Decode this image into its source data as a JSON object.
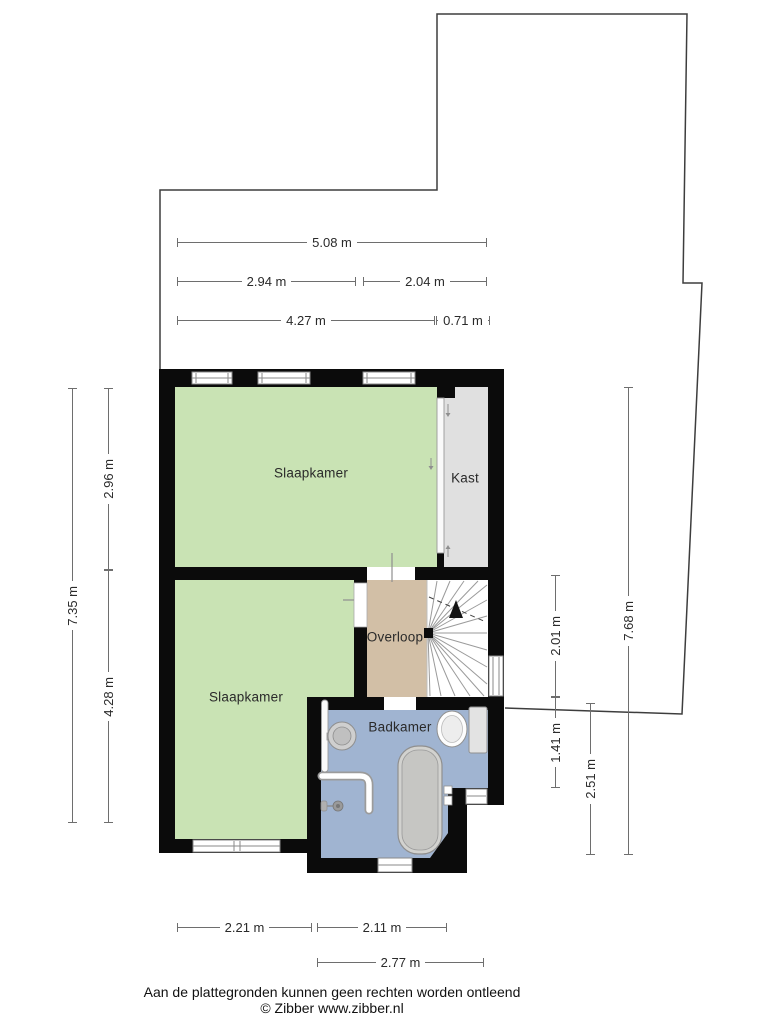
{
  "palette": {
    "wall": "#0b0b0b",
    "boundary": "#3d3d3d",
    "dim-line": "#6e6e6e",
    "text-dark": "#2a2a2a",
    "bedroom-green": "#c9e3b4",
    "closet-gray": "#e0e0e0",
    "landing-tan": "#d2bfa6",
    "bathroom-blue": "#a0b4d1",
    "fixture-fill": "#cccccc",
    "fixture-stroke": "#8f8f8f",
    "stair-line": "#9a9a9a",
    "window-stroke": "#8a8a8a"
  },
  "rooms": {
    "bedroom_top": "Slaapkamer",
    "bedroom_bottom": "Slaapkamer",
    "closet": "Kast",
    "landing": "Overloop",
    "bathroom": "Badkamer"
  },
  "dimensions": {
    "top_total": "5.08 m",
    "top_left": "2.94 m",
    "top_right": "2.04 m",
    "top_inner_left": "4.27 m",
    "top_inner_right": "0.71 m",
    "left_total": "7.35 m",
    "left_upper": "2.96 m",
    "left_lower": "4.28 m",
    "right_upper": "2.01 m",
    "right_middle": "1.41 m",
    "right_lower": "2.51 m",
    "right_total": "7.68 m",
    "bottom_left": "2.21 m",
    "bottom_right": "2.11 m",
    "bottom_total": "2.77 m"
  },
  "footer": {
    "disclaimer": "Aan de plattegronden kunnen geen rechten worden ontleend",
    "copyright": "© Zibber www.zibber.nl"
  }
}
